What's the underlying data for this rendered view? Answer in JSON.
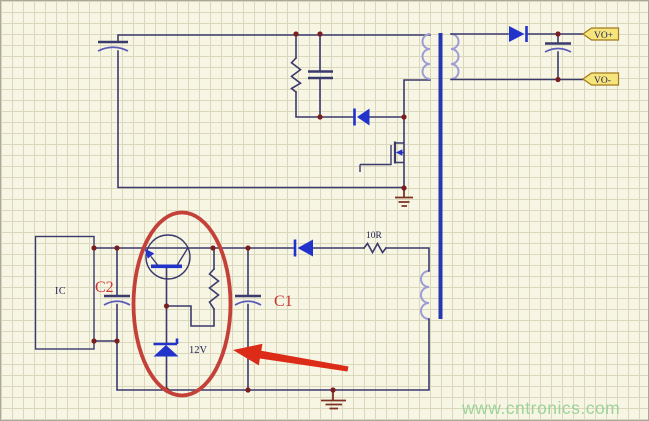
{
  "diagram": {
    "labels": {
      "ic": "IC",
      "cap_c2": "C2",
      "cap_c1": "C1",
      "zener_voltage": "12V",
      "resistor_value": "10R",
      "output_positive": "VO+",
      "output_negative": "VO-"
    },
    "watermark": "www.cntronics.com",
    "colors": {
      "background": "#f7f5e3",
      "grid": "#dad7bd",
      "wire": "#3a3a6c",
      "symbol_blue": "#2233cc",
      "coil_blue": "#9c9cd6",
      "core_blue": "#2736ae",
      "cap_arc": "#5c5cb8",
      "junction_dot": "#7a1f1f",
      "ground_brown": "#7d3222",
      "ellipse_red": "#c4413a",
      "arrow_red": "#dc2b17",
      "label_red": "#cc3333",
      "flag_fill": "#f6e57c",
      "flag_border": "#a2791c",
      "text_navy": "#1c1c50",
      "watermark_green": "#8fcf8f"
    },
    "components": [
      "input-electrolytic-capacitor",
      "snubber-resistor",
      "snubber-capacitor",
      "snubber-diode",
      "transformer-primary-winding",
      "transformer-core",
      "transformer-secondary-winding",
      "transformer-aux-winding",
      "n-mosfet",
      "output-rectifier-diode",
      "output-electrolytic-capacitor",
      "net-flag-vo-plus",
      "net-flag-vo-minus",
      "ic-block",
      "capacitor-c2",
      "npn-transistor",
      "bias-resistor",
      "zener-diode-12v",
      "capacitor-c1",
      "feedback-diode",
      "resistor-10r",
      "ground-symbol-primary",
      "ground-symbol-secondary-circuit",
      "red-highlight-ellipse",
      "red-annotation-arrow"
    ]
  }
}
